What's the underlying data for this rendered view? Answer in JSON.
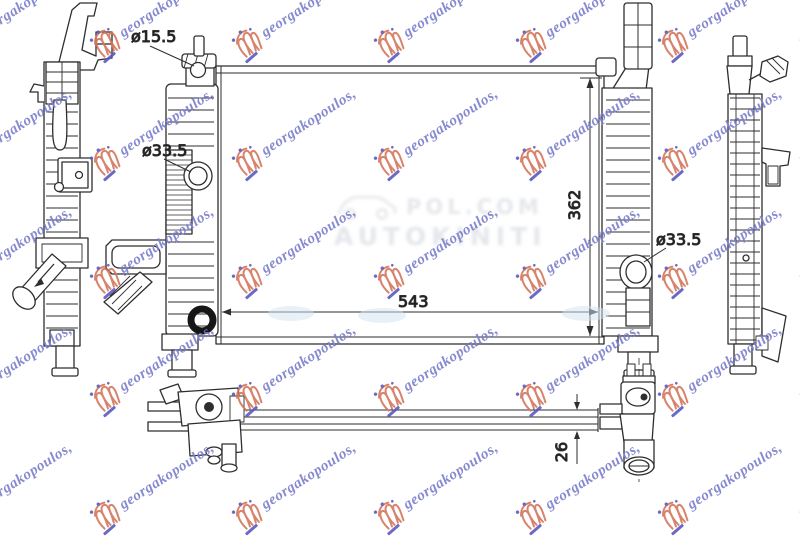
{
  "dimensions": {
    "neck": "ø15.5",
    "left_port": "ø33.5",
    "right_port": "ø33.5",
    "core_width": "543",
    "core_height": "362",
    "core_thickness": "26"
  },
  "watermark": {
    "text": "georgakopoulos,",
    "text_color": "#7b7ecb",
    "logo_primary_color": "#d4765c",
    "logo_accent_color": "#5b5bc0"
  },
  "ghost_watermark": {
    "line1": "POL.COM",
    "line2": "AUTOKINITI",
    "color": "#c9ced6"
  },
  "drawing": {
    "stroke_color": "#2e2e2e",
    "background": "#ffffff"
  }
}
